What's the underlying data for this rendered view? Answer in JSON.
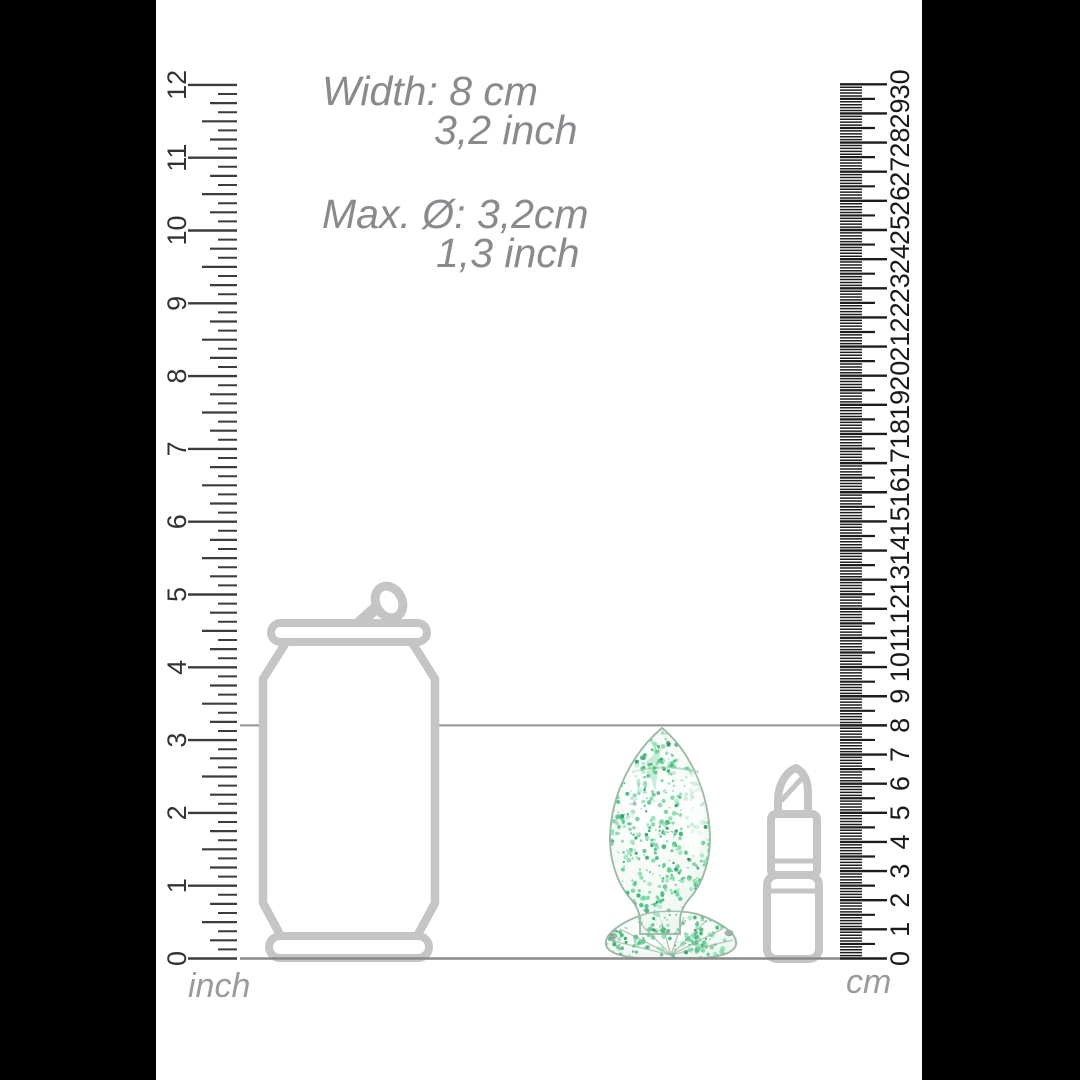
{
  "annotations": {
    "width_cm": "Width: 8 cm",
    "width_inch": "3,2 inch",
    "diameter_cm": "Max. Ø: 3,2cm",
    "diameter_inch": "1,3 inch"
  },
  "rulers": {
    "inch": {
      "unit_label": "inch",
      "numbers": [
        0,
        1,
        2,
        3,
        4,
        5,
        6,
        7,
        8,
        9,
        10,
        11,
        12
      ],
      "subdivisions_per_unit": 8
    },
    "cm": {
      "unit_label": "cm",
      "numbers": [
        0,
        1,
        2,
        3,
        4,
        5,
        6,
        7,
        8,
        9,
        10,
        11,
        12,
        13,
        14,
        15,
        16,
        17,
        18,
        19,
        20,
        21,
        22,
        23,
        24,
        25,
        26,
        27,
        28,
        29,
        30
      ],
      "subdivisions_per_unit": 10
    }
  },
  "indicator": {
    "height_cm": 8
  },
  "scale_objects": [
    "soda-can-outline",
    "glass-plug-green-speckles",
    "lipstick-outline"
  ],
  "colors": {
    "annotation_text": "#8a8a8e",
    "inch_ruler": "#3c3c3c",
    "cm_ruler": "#1d1d1d",
    "object_outline": "#c5c5c5",
    "ground_line": "#8a8a8a",
    "width_line": "#9c9c9c",
    "speckle_palette": [
      "#43bd7d",
      "#5fce92",
      "#2da066",
      "#7bdba6",
      "#36b274",
      "#8ee2b4"
    ],
    "speckle_dark": "#2e7d53"
  }
}
